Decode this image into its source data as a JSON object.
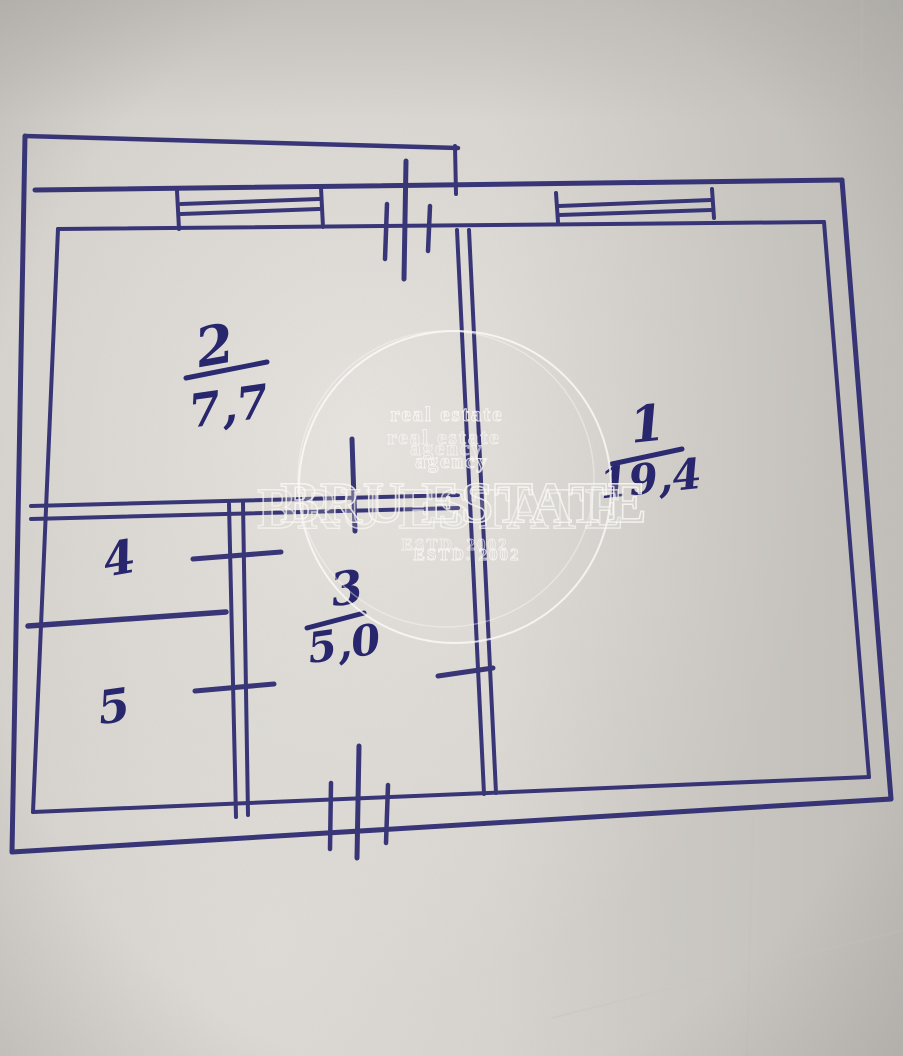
{
  "floor_plan": {
    "description_label": "hand-drawn apartment floor plan",
    "rooms": [
      {
        "number": "1",
        "area": "19,4"
      },
      {
        "number": "2",
        "area": "7,7"
      },
      {
        "number": "3",
        "area": "5,0"
      },
      {
        "number": "4",
        "area": ""
      },
      {
        "number": "5",
        "area": ""
      }
    ]
  },
  "watermark": {
    "tagline_line1": "real estate",
    "tagline_line2": "real estate",
    "tagline_line3": "agency",
    "tagline_line3_ghost": "agency",
    "brand": "BRU ESTATE",
    "brand_ghost": "BRU ESTATE",
    "estd": "ESTD. 2002",
    "estd_ghost": "ESTD. 2002"
  },
  "colors": {
    "ink": "#2c2a70",
    "paper": "#d5d2cd",
    "paper_glare": "#e8e5e0",
    "watermark_stroke": "#fdfcf9"
  }
}
